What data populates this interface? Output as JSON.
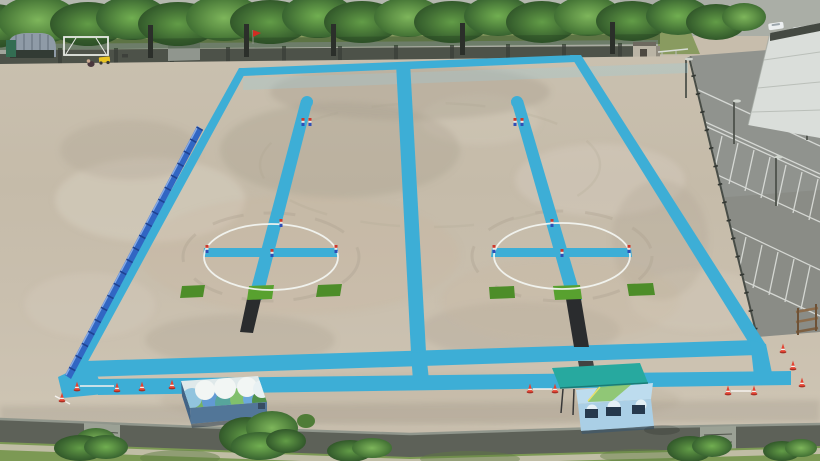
{
  "scene": {
    "description": "Aerial drone view of a school sports ground: bare dirt field painted with two parallel blue event courses, each with a white center circle, blue cross, center lane line, green turf mats and a black rubber strip; tree row and wall at top, parking lot at right, murals on two container buildings at bottom",
    "field_count": 2,
    "per_field": {
      "white_circle": 1,
      "blue_cross": 1,
      "center_lane_line": 1,
      "green_mats": 3,
      "black_strip": 1,
      "small_markers": 6
    },
    "props": {
      "traffic_cones": 12,
      "mural_buildings": 2,
      "blue_barrier_fence_side": "left",
      "shelter_top_left": 1,
      "soccer_goal_top_left": 1,
      "line_marking_machine": 1,
      "person_crouching": 1,
      "red_flag_on_wall": 1,
      "small_shed_top": 1,
      "parking_light_poles": 4,
      "parked_cars_top": 5
    }
  },
  "palette": {
    "paint_blue": "#3aadd6",
    "paint_blue_wash": "#8fd0e4",
    "fence_blue": "#2d63c2",
    "fence_blue_post": "#1a3f8f",
    "mat_green": "#4a8b25",
    "mat_green_bright": "#55a02b",
    "black_strip": "#26282a",
    "circle_white": "#f2f4f0",
    "cone_red": "#e2402e",
    "marker_red": "#cf3326",
    "marker_blue": "#2a4bb5",
    "dirt_light": "#cdc4b4",
    "dirt_mid": "#c2b8a6",
    "asphalt": "#8e918c",
    "wall_dark": "#4a4f46",
    "bottom_wall": "#5a5e55",
    "tree_green": "#4a7d36",
    "grass_green": "#7a9751",
    "canopy_teal": "#23a89e",
    "building_white": "#dadeda",
    "mural_sky_blue": "#a9cfe6"
  }
}
